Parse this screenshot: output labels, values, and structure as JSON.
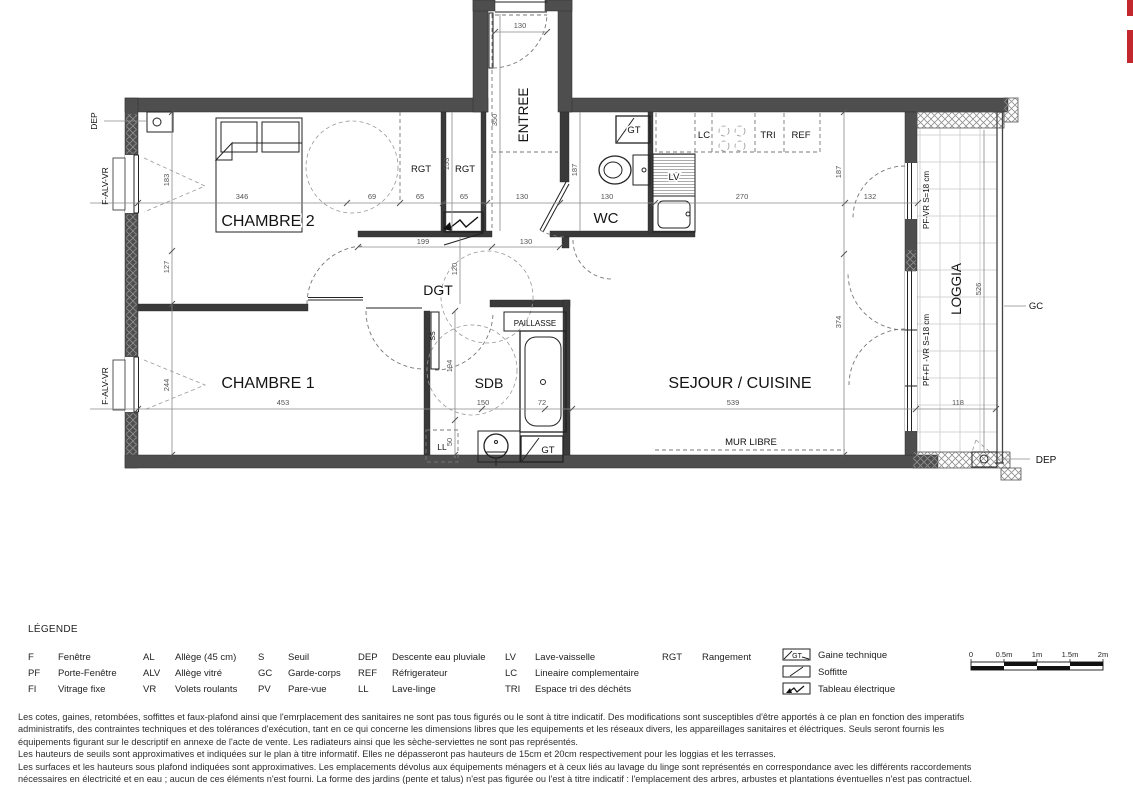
{
  "plan": {
    "rooms": {
      "chambre2": "CHAMBRE 2",
      "chambre1": "CHAMBRE 1",
      "entree": "ENTREE",
      "wc": "WC",
      "dgt": "DGT",
      "sdb": "SDB",
      "sejour_cuisine": "SEJOUR / CUISINE",
      "loggia": "LOGGIA"
    },
    "features": {
      "rgt1": "RGT",
      "rgt2": "RGT",
      "gt_wc": "GT",
      "gt_sdb": "GT",
      "lv": "LV",
      "lc": "LC",
      "tri": "TRI",
      "ref": "REF",
      "ll": "LL",
      "ss": "SS",
      "paillasse": "PAILLASSE",
      "mur_libre": "MUR LIBRE",
      "gc": "GC",
      "dep_left": "DEP",
      "dep_right": "DEP",
      "window_left_top": "F-ALV-VR",
      "window_left_bottom": "F-ALV-VR",
      "window_right_top": "PF-VR  S=18 cm",
      "window_right_bottom": "PF+FI -VR  S=18 cm"
    },
    "dims": {
      "d346": "346",
      "d69": "69",
      "d65a": "65",
      "d65b": "65",
      "d130_top": "130",
      "d130_entree": "130",
      "d130_wc": "130",
      "d130_dgt": "130",
      "d270": "270",
      "d132": "132",
      "d183": "183",
      "d127": "127",
      "d244": "244",
      "d153": "153",
      "d350": "350",
      "d187_wc": "187",
      "d187_sejour": "187",
      "d374": "374",
      "d199": "199",
      "d120": "120",
      "d194": "194",
      "d150": "150",
      "d72": "72",
      "d50": "50",
      "d453": "453",
      "d539": "539",
      "d526": "526",
      "d118": "118"
    }
  },
  "legend": {
    "title": "LÉGENDE",
    "col1": [
      {
        "abbr": "F",
        "label": "Fenêtre"
      },
      {
        "abbr": "PF",
        "label": "Porte-Fenêtre"
      },
      {
        "abbr": "FI",
        "label": "Vitrage fixe"
      }
    ],
    "col2": [
      {
        "abbr": "AL",
        "label": "Allège (45 cm)"
      },
      {
        "abbr": "ALV",
        "label": "Allège vitré"
      },
      {
        "abbr": "VR",
        "label": "Volets roulants"
      }
    ],
    "col3": [
      {
        "abbr": "S",
        "label": "Seuil"
      },
      {
        "abbr": "GC",
        "label": "Garde-corps"
      },
      {
        "abbr": "PV",
        "label": "Pare-vue"
      }
    ],
    "col4": [
      {
        "abbr": "DEP",
        "label": "Descente eau pluviale"
      },
      {
        "abbr": "REF",
        "label": "Réfrigerateur"
      },
      {
        "abbr": "LL",
        "label": "Lave-linge"
      }
    ],
    "col5": [
      {
        "abbr": "LV",
        "label": "Lave-vaisselle"
      },
      {
        "abbr": "LC",
        "label": "Lineaire complementaire"
      },
      {
        "abbr": "TRI",
        "label": "Espace tri des déchéts"
      }
    ],
    "col6": [
      {
        "abbr": "RGT",
        "label": "Rangement"
      }
    ],
    "symbols": [
      {
        "label": "Gaine technique"
      },
      {
        "label": "Soffitte"
      },
      {
        "label": "Tableau électrique"
      }
    ],
    "gt_symbol_text": "GT"
  },
  "scalebar": {
    "ticks": [
      "0",
      "0.5m",
      "1m",
      "1.5m",
      "2m"
    ]
  },
  "disclaimer": {
    "lines": [
      "Les cotes, gaines, retombées, soffittes et faux-plafond ainsi que l'emrplacement des sanitaires ne sont  pas tous figurés ou le sont à titre indicatif. Des modifications sont susceptibles d'être apportés à ce plan en fonction des imperatifs",
      "administratifs, des contraintes techniques et des tolérances d'exécution, tant en ce qui concerne les dimensions libres que les equipements et les réseaux divers, les appareillages sanitaires et éléctriques. Seuls seront fournis les",
      "équipements figurant sur le descriptif en annexe de l'acte de vente. Les radiateurs ainsi que les sèche-serviettes ne sont pas représentés.",
      "Les hauteurs de seuils sont approximatives et indiquées sur le plan à titre informatif. Elles ne dépasseront pas hauteurs de 15cm et 20cm respectivement pour les loggias et les terrasses.",
      "Les surfaces et les hauteurs sous plafond indiquées sont approximatives. Les emplacements dévolus aux équipements ménagers et à ceux liés au lavage du linge sont représentés en correspondance avec les différents raccordements",
      "nécessaires en électricité et en eau ; aucun de ces éléments n'est fourni. La forme des jardins (pente et talus) n'est pas figurée ou l'est à titre indicatif : l'emplacement des arbres, arbustes et plantations éventuelles n'est pas contractuel."
    ]
  }
}
